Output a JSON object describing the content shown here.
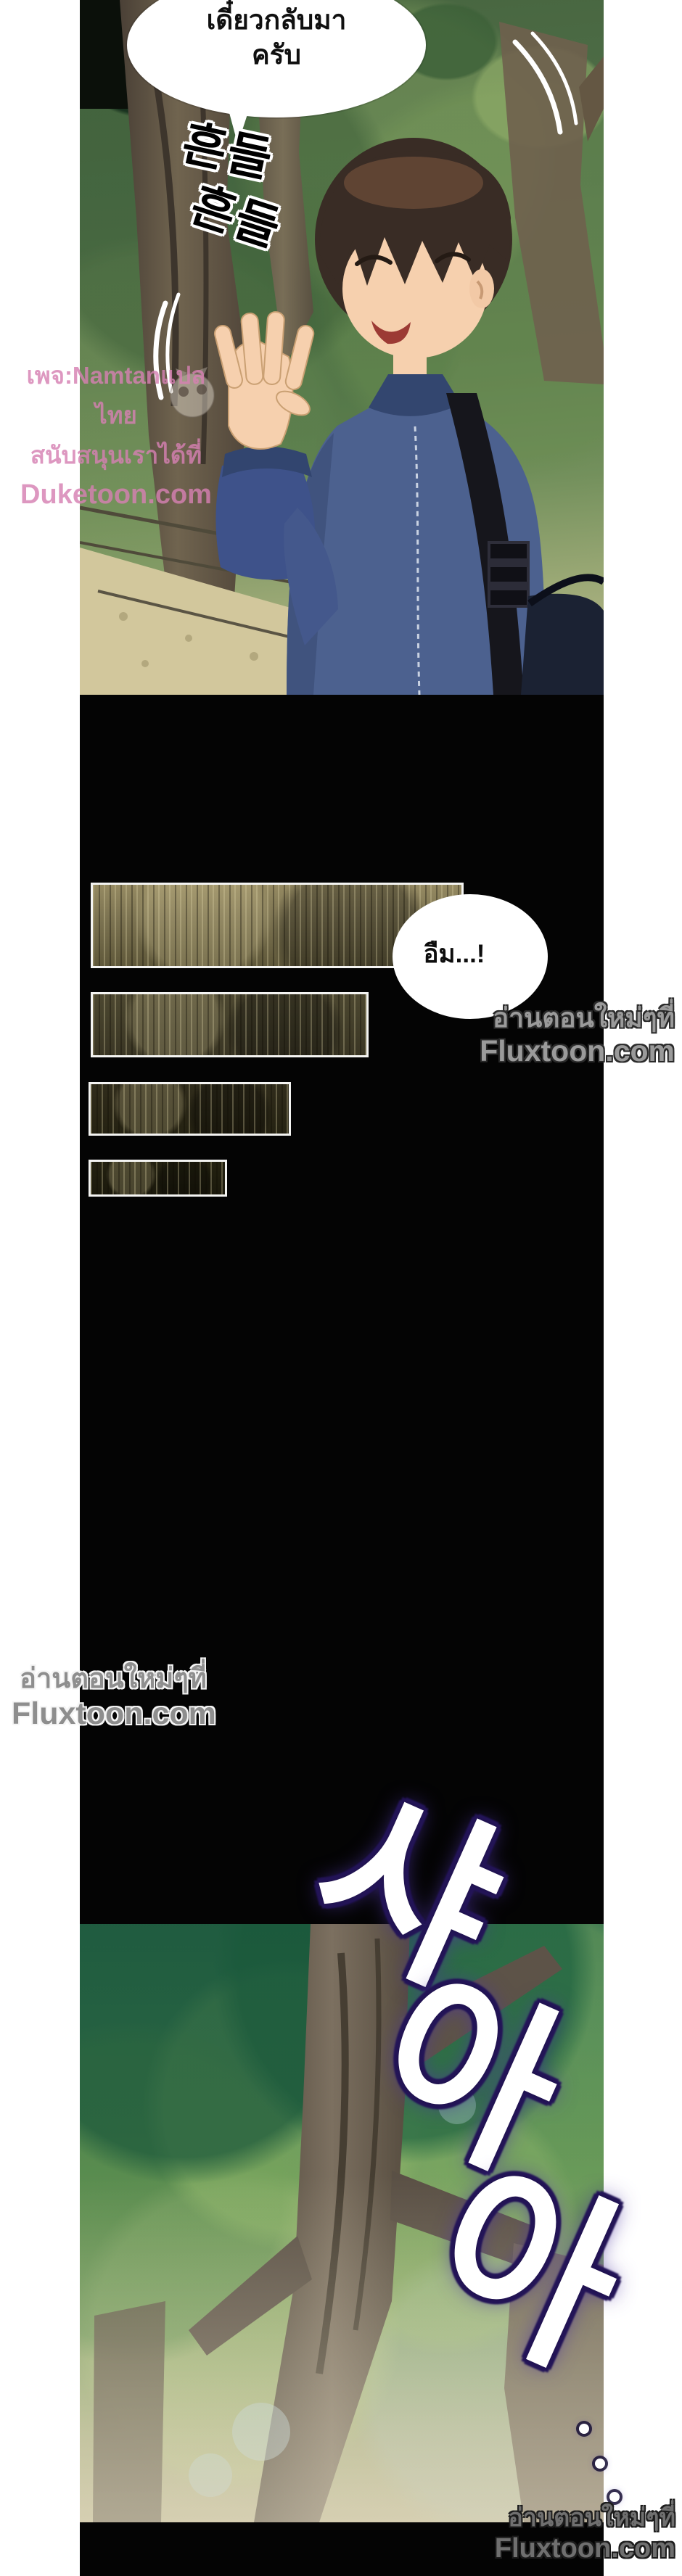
{
  "page": {
    "background": "#ffffff",
    "comic_background": "#000000",
    "description": "webtoon comic page"
  },
  "top_panel": {
    "speech_bubble": {
      "line1": "เดี๋ยวกลับมา",
      "line2": "ครับ"
    },
    "shake_sfx": {
      "text": "흔들흔들",
      "line1": "흔들",
      "line2": "흔들"
    },
    "translator_watermark": {
      "line1": "เพจ:Namtanแปลไทย",
      "line2": "สนับสนุนเราได้ที่",
      "line3": "Duketoon.com",
      "color": "#d680b2"
    }
  },
  "black_section": {
    "hmm_bubble": {
      "text": "อืม...!"
    },
    "redacted_bars": [
      {
        "id": 1,
        "tone": "#7d7452"
      },
      {
        "id": 2,
        "tone": "#3a3624"
      },
      {
        "id": 3,
        "tone": "#252212"
      },
      {
        "id": 4,
        "tone": "#1b190c"
      }
    ],
    "watermark_right": {
      "line1": "อ่านตอนใหม่ๆที่",
      "line2": "Fluxtoon.com"
    },
    "watermark_left": {
      "line1": "อ่านตอนใหม่ๆที่",
      "line2": "Fluxtoon.com"
    }
  },
  "bottom_panel": {
    "wind_sfx": {
      "text": "샤아아",
      "char1": "샤",
      "char2": "아",
      "char3": "아"
    },
    "watermark_bottom": {
      "line1": "อ่านตอนใหม่ๆที่",
      "line2": "Fluxtoon.com"
    },
    "glow_color": "#251659"
  },
  "colors": {
    "watermark_gray": "#9a9a9a",
    "bubble_text": "#101010",
    "jacket_blue": "#4c618f"
  }
}
